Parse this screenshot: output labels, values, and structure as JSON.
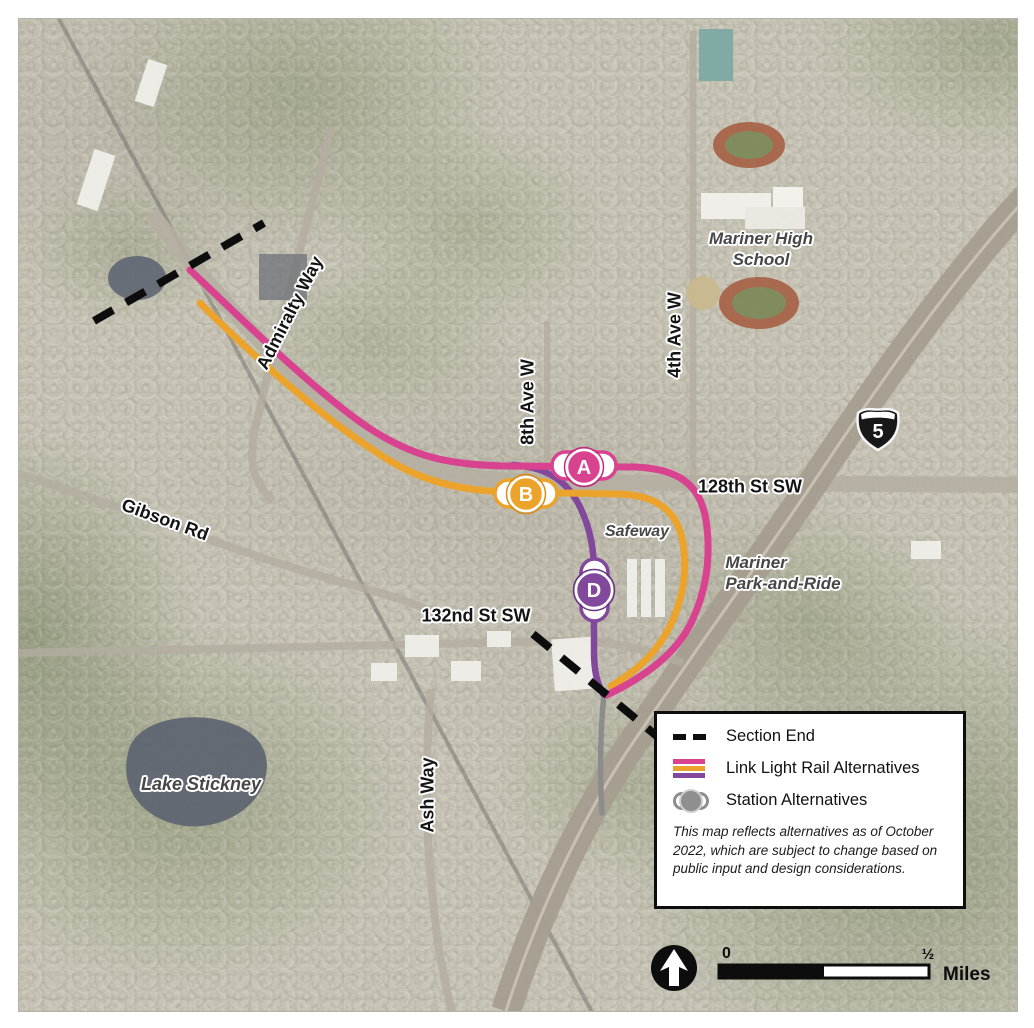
{
  "colors": {
    "pink": "#d8428f",
    "orange": "#ebA32c",
    "purple": "#82489c",
    "gray_route": "#8c8c8c",
    "section_end": "#0d0d0d"
  },
  "street_labels": {
    "admiralty_way": "Admiralty Way",
    "gibson_rd": "Gibson Rd",
    "eighth_ave_w": "8th Ave W",
    "fourth_ave_w": "4th Ave W",
    "st_128": "128th St SW",
    "st_132": "132nd St SW",
    "ash_way": "Ash Way"
  },
  "place_labels": {
    "mariner_high_school": [
      "Mariner High",
      "School"
    ],
    "safeway": "Safeway",
    "mariner_park_and_ride": [
      "Mariner",
      "Park-and-Ride"
    ],
    "lake_stickney": "Lake Stickney"
  },
  "stations": {
    "a": "A",
    "b": "B",
    "d": "D"
  },
  "highway_shield": {
    "number": "5"
  },
  "legend": {
    "section_end": "Section End",
    "link_light_rail": "Link Light Rail Alternatives",
    "station_alternatives": "Station Alternatives",
    "note": [
      "This map reflects alternatives as of October",
      "2022, which are subject to change based on",
      "public input and design considerations."
    ]
  },
  "scale_bar": {
    "zero": "0",
    "half": "½",
    "unit": "Miles"
  }
}
